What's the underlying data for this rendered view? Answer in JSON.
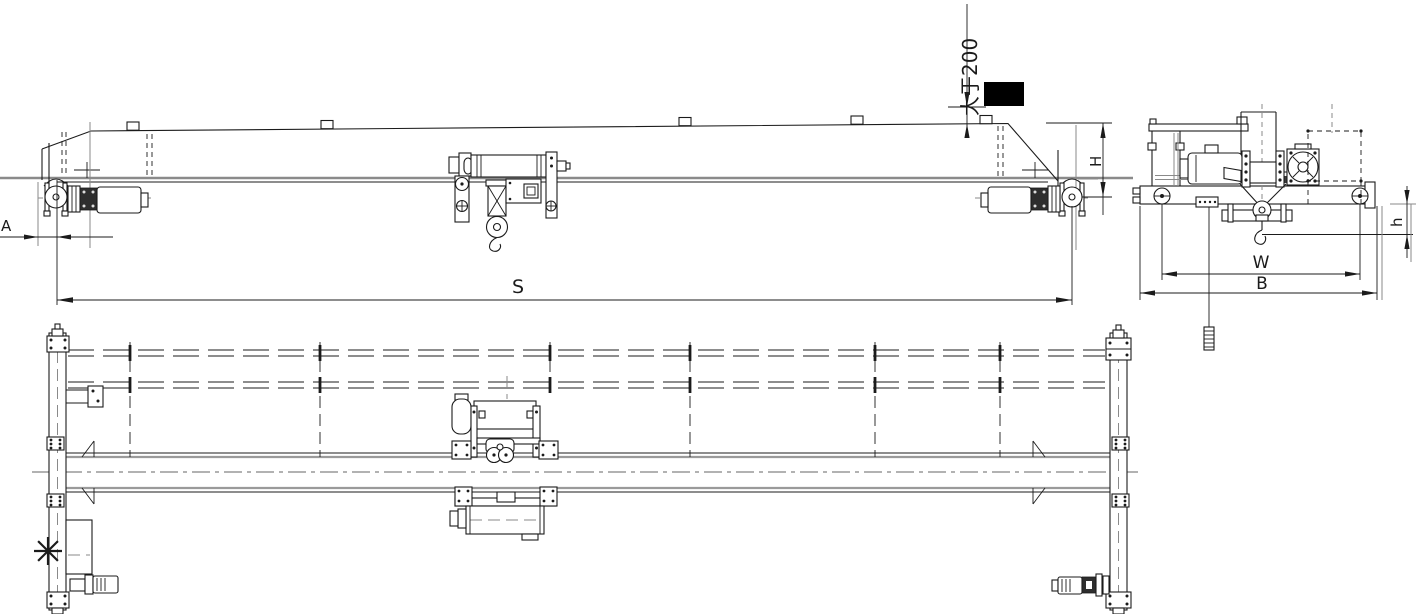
{
  "drawing": {
    "labels": {
      "clearance_note": "大于200",
      "span_dim": "S",
      "approach_dim": "A",
      "height_dim": "H",
      "gauge_dim": "W",
      "base_dim": "B",
      "hook_dim": "h"
    },
    "colors": {
      "line": "#1b1b1b",
      "auxiliary": "#8a8a8a",
      "solid_block": "#000000",
      "background": "#ffffff"
    }
  }
}
